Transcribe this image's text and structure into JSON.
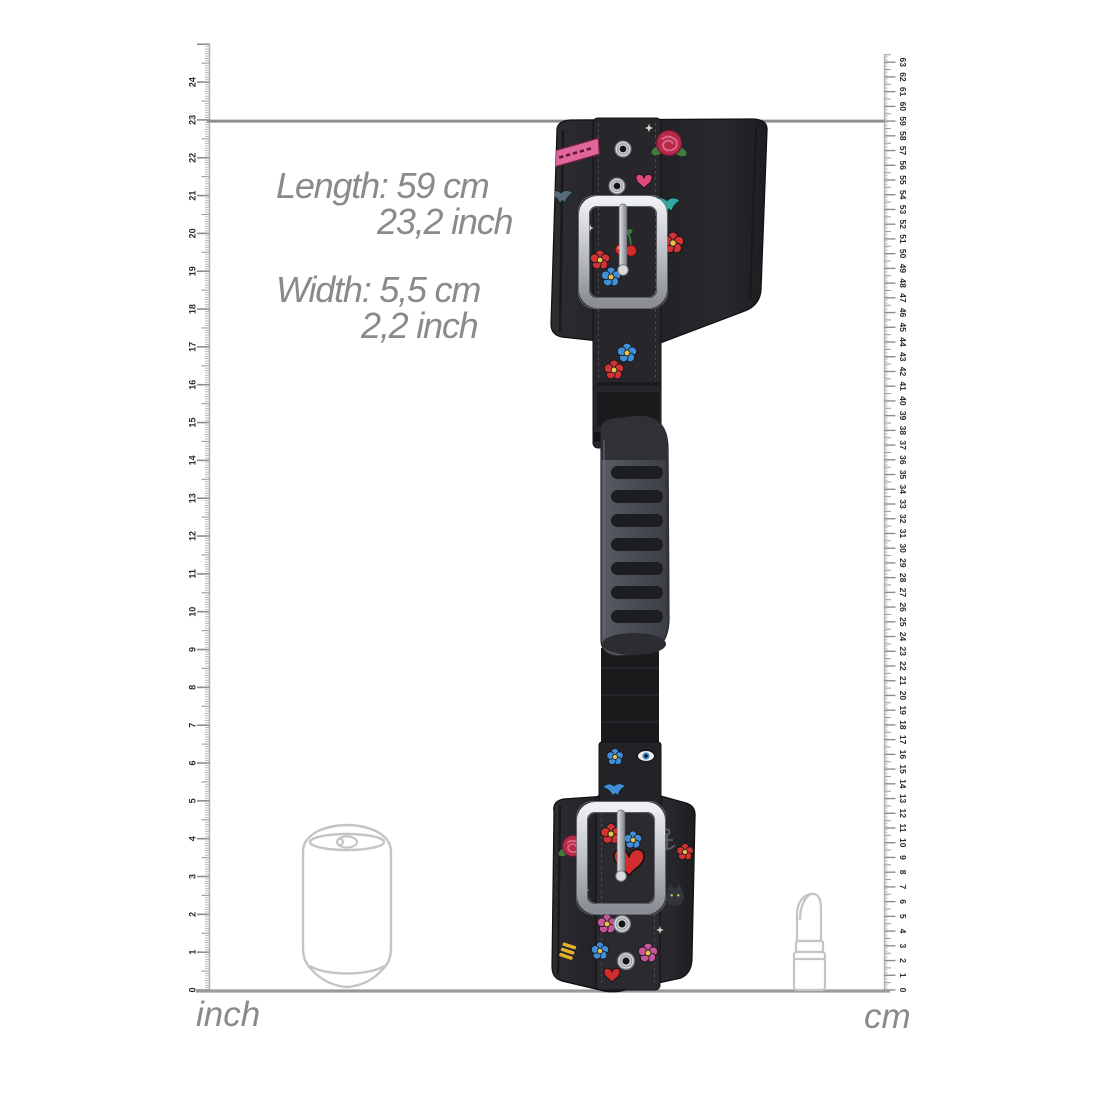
{
  "dimensions": {
    "length_metric": "Length: 59 cm",
    "length_imperial": "23,2 inch",
    "width_metric": "Width: 5,5 cm",
    "width_imperial": "2,2 inch"
  },
  "rulers": {
    "inch": {
      "label": "inch",
      "min": 0,
      "max": 24,
      "side": "left"
    },
    "cm": {
      "label": "cm",
      "min": 0,
      "max": 63,
      "side": "right"
    }
  },
  "indicator": {
    "length_cm": 59,
    "length_inch": 23.2
  },
  "reference_objects": [
    {
      "name": "soda-can",
      "style": "light-gray-outline"
    },
    {
      "name": "lipstick",
      "style": "light-gray-outline"
    }
  ],
  "product": {
    "name": "tattoo-print-wrist-cuffs-with-grip-handle",
    "parts": [
      "top-cuff",
      "top-buckle",
      "eyelets",
      "adjuster-strap",
      "grip-handle",
      "webbing-strap",
      "bottom-cuff",
      "bottom-buckle"
    ],
    "print_motifs": [
      {
        "type": "banner",
        "x": 575,
        "y": 153,
        "s": 1.1,
        "c": "#e0679b"
      },
      {
        "type": "rose",
        "x": 669,
        "y": 143,
        "s": 1.2
      },
      {
        "type": "swallow",
        "x": 561,
        "y": 196,
        "s": 1.0,
        "c": "#5a6b78"
      },
      {
        "type": "heart",
        "x": 644,
        "y": 181,
        "s": 0.8,
        "c": "#e0487c"
      },
      {
        "type": "swallow",
        "x": 667,
        "y": 204,
        "s": 1.1,
        "c": "#2fa8a2"
      },
      {
        "type": "cherry",
        "x": 625,
        "y": 243,
        "s": 1.1
      },
      {
        "type": "flower",
        "x": 673,
        "y": 243,
        "s": 1.1,
        "c": "#d23333"
      },
      {
        "type": "flower",
        "x": 600,
        "y": 260,
        "s": 1.0,
        "c": "#d23333"
      },
      {
        "type": "flower",
        "x": 611,
        "y": 277,
        "s": 1.0,
        "c": "#3f8fd8"
      },
      {
        "type": "star",
        "x": 649,
        "y": 128,
        "s": 0.8,
        "c": "#f0ead8"
      },
      {
        "type": "star",
        "x": 590,
        "y": 228,
        "s": 0.7,
        "c": "#f0ead8"
      },
      {
        "type": "flower",
        "x": 627,
        "y": 353,
        "s": 1.0,
        "c": "#3f8fd8"
      },
      {
        "type": "flower",
        "x": 614,
        "y": 370,
        "s": 1.0,
        "c": "#d23333"
      },
      {
        "type": "swallow",
        "x": 614,
        "y": 789,
        "s": 0.95,
        "c": "#3f8fd8"
      },
      {
        "type": "flower",
        "x": 615,
        "y": 757,
        "s": 0.85,
        "c": "#3f8fd8"
      },
      {
        "type": "eye",
        "x": 646,
        "y": 756,
        "s": 1.0
      },
      {
        "type": "rose",
        "x": 573,
        "y": 846,
        "s": 1.0
      },
      {
        "type": "flower",
        "x": 611,
        "y": 834,
        "s": 1.05,
        "c": "#d23333"
      },
      {
        "type": "flower",
        "x": 633,
        "y": 840,
        "s": 0.9,
        "c": "#3f8fd8"
      },
      {
        "type": "heart",
        "x": 629,
        "y": 862,
        "s": 1.5,
        "c": "#d22c2c"
      },
      {
        "type": "flower",
        "x": 607,
        "y": 924,
        "s": 1.0,
        "c": "#c8559a"
      },
      {
        "type": "flower",
        "x": 648,
        "y": 953,
        "s": 1.0,
        "c": "#c8559a"
      },
      {
        "type": "flower",
        "x": 600,
        "y": 951,
        "s": 0.9,
        "c": "#3f8fd8"
      },
      {
        "type": "stripes",
        "x": 568,
        "y": 950,
        "s": 1.0,
        "c": "#e8b02a"
      },
      {
        "type": "cat",
        "x": 675,
        "y": 897,
        "s": 1.1
      },
      {
        "type": "anchor",
        "x": 667,
        "y": 840,
        "s": 1.0
      },
      {
        "type": "flower",
        "x": 685,
        "y": 852,
        "s": 0.85,
        "c": "#d23333"
      },
      {
        "type": "heart",
        "x": 612,
        "y": 975,
        "s": 0.8,
        "c": "#d22c2c"
      },
      {
        "type": "star",
        "x": 660,
        "y": 930,
        "s": 0.7,
        "c": "#f0ead8"
      },
      {
        "type": "star",
        "x": 586,
        "y": 890,
        "s": 0.6,
        "c": "#f0ead8"
      }
    ]
  },
  "colors": {
    "text_gray": "#8a8a8d",
    "indicator_line": "#8f8f8f",
    "baseline": "#9a9a9a",
    "ruler_line": "#b0b0b0",
    "ruler_tick_major": "#8c8c8c",
    "ruler_tick_mid": "#9a9a9a",
    "ruler_tick_minor": "#a8a8a8",
    "ruler_number": "#2b2b2b",
    "outline_gray": "#c4c4c6",
    "cuff_black": "#222226",
    "strap_black": "#1a1a1d",
    "handle_gray": "#4e5157",
    "buckle_silver": "#cdd0d5"
  }
}
